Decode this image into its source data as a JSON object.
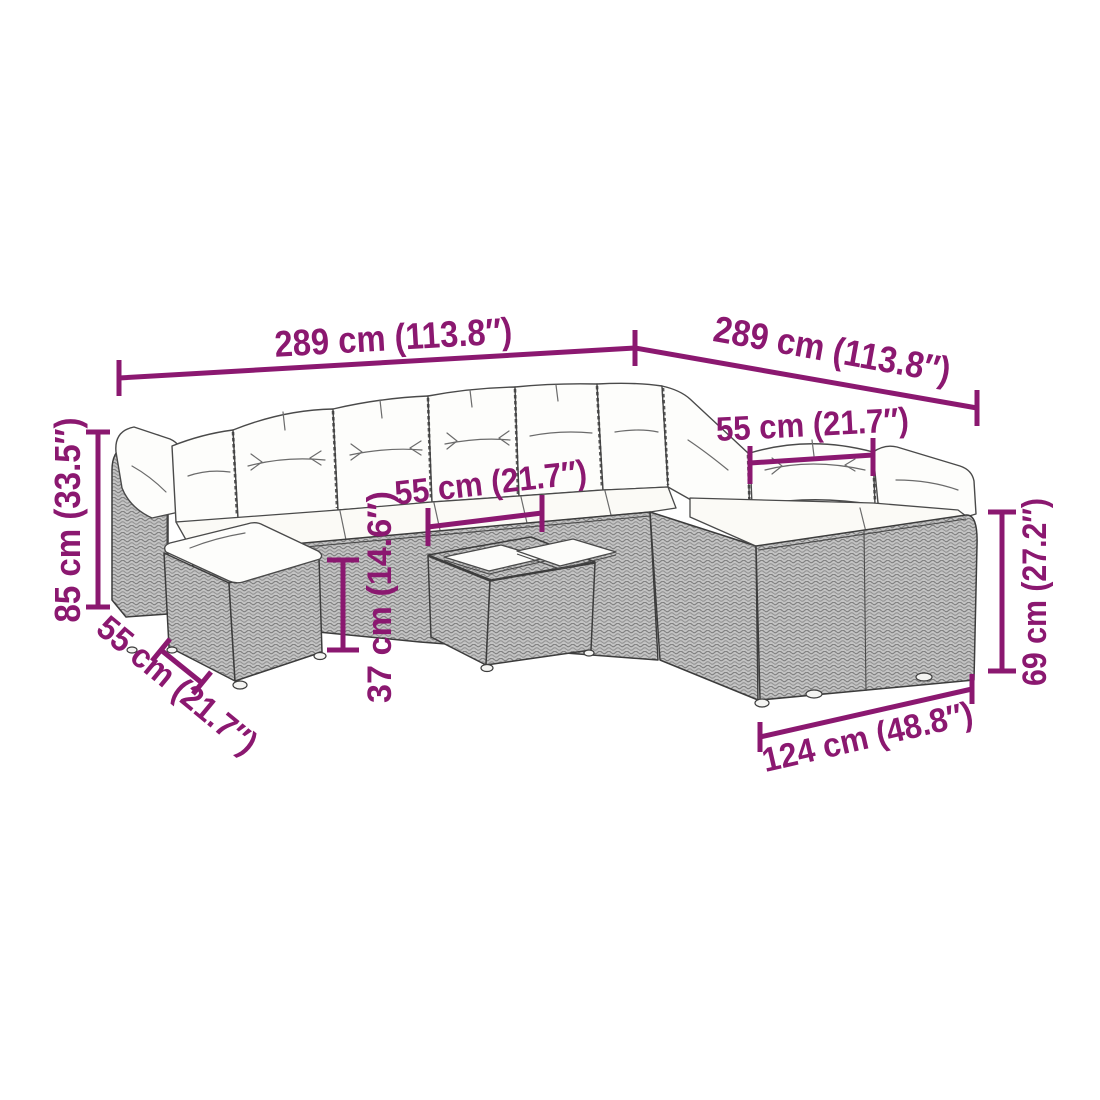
{
  "diagram": {
    "kind": "product-dimension-diagram",
    "subject": "poly rattan garden corner sofa set with cushions, ottoman and coffee table",
    "background": "#FFFFFF"
  },
  "colors": {
    "dimension_accent": "#8B1870",
    "wicker_gray": "#C4C4C4",
    "wicker_weave_dark": "#808080",
    "line_art": "#3C3C3C",
    "cushion_white": "#FDFDFB"
  },
  "dims": {
    "overall_width_left": "289 cm (113.8″)",
    "overall_depth_right": "289 cm (113.8″)",
    "seat_width": "55 cm (21.7″)",
    "table_width": "55 cm (21.7″)",
    "overall_height": "85 cm (33.5″)",
    "table_height": "37 cm (14.6″)",
    "ottoman_width": "55 cm (21.7″)",
    "backrest_height": "69 cm (27.2″)",
    "right_module_length": "124 cm (48.8″)"
  }
}
